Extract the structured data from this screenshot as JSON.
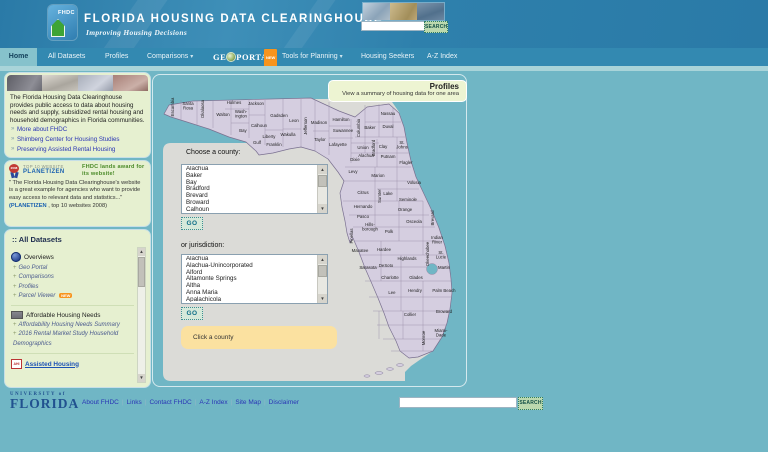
{
  "header": {
    "logo_text": "FHDC",
    "title": "FLORIDA HOUSING DATA CLEARINGHOUSE",
    "tagline": "Improving Housing Decisions",
    "search_placeholder": "",
    "search_button": "SEARCH"
  },
  "nav": {
    "items": [
      {
        "label": "Home",
        "active": true
      },
      {
        "label": "All Datasets"
      },
      {
        "label": "Profiles"
      },
      {
        "label": "Comparisons",
        "dropdown": true
      },
      {
        "label": "GEOPORTAL",
        "geo": true,
        "geo_parts": [
          "GE",
          "PORTAL"
        ],
        "badge": "NEW"
      },
      {
        "label": "Tools for Planning",
        "dropdown": true
      },
      {
        "label": "Housing Seekers"
      },
      {
        "label": "A-Z Index"
      }
    ]
  },
  "sidebar": {
    "intro": {
      "text": "The Florida Housing Data Clearinghouse provides public access to data about housing needs and supply, subsidized rental housing and household demographics in Florida communities.",
      "links": [
        "More about FHDC",
        "Shimberg Center for Housing Studies",
        "Preserving Assisted Rental Housing"
      ]
    },
    "award": {
      "year": "2008",
      "top_label": "TOP 10 WEBSITE",
      "brand": "PLANETIZEN",
      "headline": "FHDC lands award for its website!",
      "quote": "\" The Florida Housing Data Clearinghouse's website is a great example for agencies who want to provide easy access to relevant data and statistics...\"",
      "credit_brand": "(PLANETIZEN",
      "credit_rest": " , top 10 websites 2008)"
    },
    "datasets": {
      "title": ":: All Datasets",
      "sections": [
        {
          "heading": "Overviews",
          "icon": "globe",
          "links": [
            {
              "label": "Geo Portal"
            },
            {
              "label": "Comparisons"
            },
            {
              "label": "Profiles"
            },
            {
              "label": "Parcel Viewer",
              "badge": "NEW"
            }
          ]
        },
        {
          "heading": "Affordable Housing Needs",
          "icon": "building",
          "links": [
            {
              "label": "Affordability Housing Needs Summary"
            },
            {
              "label": "2016 Rental Market Study Household Demographics"
            }
          ]
        },
        {
          "heading": "Assisted Housing",
          "icon": "ahi",
          "heading_link": true,
          "links": []
        }
      ]
    }
  },
  "main": {
    "profiles_title": "Profiles",
    "profiles_subtitle": "View a summary of housing data for one area",
    "county_label": "Choose a county:",
    "county_options": [
      "Alachua",
      "Baker",
      "Bay",
      "Bradford",
      "Brevard",
      "Broward",
      "Calhoun"
    ],
    "go_label": "GO",
    "jurisdiction_label": "or jurisdiction:",
    "jurisdiction_options": [
      "Alachua",
      "Alachua-Unincorporated",
      "Alford",
      "Altamonte Springs",
      "Altha",
      "Anna Maria",
      "Apalachicola"
    ],
    "hint": "Click a county"
  },
  "map": {
    "counties": [
      {
        "n": "Escambia",
        "x": 21,
        "y": 32,
        "r": 1
      },
      {
        "n": "Santa|Rosa",
        "x": 35,
        "y": 30
      },
      {
        "n": "Okaloosa",
        "x": 51,
        "y": 34,
        "r": 1
      },
      {
        "n": "Walton",
        "x": 70,
        "y": 41
      },
      {
        "n": "Holmes",
        "x": 81,
        "y": 29
      },
      {
        "n": "Wash-|ington",
        "x": 88,
        "y": 38
      },
      {
        "n": "Jackson",
        "x": 103,
        "y": 30
      },
      {
        "n": "Bay",
        "x": 90,
        "y": 57
      },
      {
        "n": "Calhoun",
        "x": 106,
        "y": 52
      },
      {
        "n": "Gadsden",
        "x": 126,
        "y": 42
      },
      {
        "n": "Liberty",
        "x": 116,
        "y": 63
      },
      {
        "n": "Gulf",
        "x": 104,
        "y": 69
      },
      {
        "n": "Franklin",
        "x": 121,
        "y": 71
      },
      {
        "n": "Leon",
        "x": 141,
        "y": 47
      },
      {
        "n": "Wakulla",
        "x": 135,
        "y": 61
      },
      {
        "n": "Jefferson",
        "x": 154,
        "y": 51,
        "r": 1
      },
      {
        "n": "Madison",
        "x": 166,
        "y": 49
      },
      {
        "n": "Taylor",
        "x": 167,
        "y": 66
      },
      {
        "n": "Hamilton",
        "x": 188,
        "y": 46
      },
      {
        "n": "Suwannee",
        "x": 190,
        "y": 57
      },
      {
        "n": "Lafayette",
        "x": 185,
        "y": 71
      },
      {
        "n": "Dixie",
        "x": 202,
        "y": 86
      },
      {
        "n": "Columbia",
        "x": 207,
        "y": 53,
        "r": 1
      },
      {
        "n": "Baker",
        "x": 217,
        "y": 54
      },
      {
        "n": "Nassau",
        "x": 235,
        "y": 40
      },
      {
        "n": "Duval",
        "x": 235,
        "y": 53
      },
      {
        "n": "Union",
        "x": 210,
        "y": 74
      },
      {
        "n": "Bradford",
        "x": 222,
        "y": 73,
        "r": 1
      },
      {
        "n": "Clay",
        "x": 230,
        "y": 73
      },
      {
        "n": "St.|Johns",
        "x": 249,
        "y": 69
      },
      {
        "n": "Alachua",
        "x": 213,
        "y": 82
      },
      {
        "n": "Putnam",
        "x": 235,
        "y": 83
      },
      {
        "n": "Flagler",
        "x": 253,
        "y": 89
      },
      {
        "n": "Levy",
        "x": 200,
        "y": 98
      },
      {
        "n": "Marion",
        "x": 225,
        "y": 102
      },
      {
        "n": "Volusia",
        "x": 261,
        "y": 109
      },
      {
        "n": "Citrus",
        "x": 210,
        "y": 119
      },
      {
        "n": "Lake",
        "x": 235,
        "y": 120
      },
      {
        "n": "Sumter",
        "x": 228,
        "y": 121,
        "r": 1
      },
      {
        "n": "Seminole",
        "x": 255,
        "y": 126
      },
      {
        "n": "Hernando",
        "x": 210,
        "y": 133
      },
      {
        "n": "Orange",
        "x": 252,
        "y": 136
      },
      {
        "n": "Pasco",
        "x": 210,
        "y": 143
      },
      {
        "n": "Osceola",
        "x": 261,
        "y": 148
      },
      {
        "n": "Brevard",
        "x": 281,
        "y": 143,
        "r": 1
      },
      {
        "n": "Hills-|borough",
        "x": 217,
        "y": 151
      },
      {
        "n": "Pinellas",
        "x": 200,
        "y": 161,
        "r": 1
      },
      {
        "n": "Polk",
        "x": 236,
        "y": 158
      },
      {
        "n": "Indian|River",
        "x": 284,
        "y": 164
      },
      {
        "n": "Manatee",
        "x": 207,
        "y": 177
      },
      {
        "n": "Hardee",
        "x": 231,
        "y": 176
      },
      {
        "n": "Highlands",
        "x": 254,
        "y": 185
      },
      {
        "n": "Okeechobee",
        "x": 276,
        "y": 179,
        "r": 1
      },
      {
        "n": "St.|Lucie",
        "x": 288,
        "y": 179
      },
      {
        "n": "Sarasota",
        "x": 215,
        "y": 194
      },
      {
        "n": "DeSoto",
        "x": 233,
        "y": 192
      },
      {
        "n": "Martin",
        "x": 291,
        "y": 194
      },
      {
        "n": "Charlotte",
        "x": 237,
        "y": 204
      },
      {
        "n": "Glades",
        "x": 263,
        "y": 204
      },
      {
        "n": "Lee",
        "x": 239,
        "y": 219
      },
      {
        "n": "Hendry",
        "x": 262,
        "y": 217
      },
      {
        "n": "Palm Beach",
        "x": 291,
        "y": 217
      },
      {
        "n": "Collier",
        "x": 257,
        "y": 241
      },
      {
        "n": "Broward",
        "x": 291,
        "y": 238
      },
      {
        "n": "Monroe",
        "x": 272,
        "y": 263,
        "r": 1
      },
      {
        "n": "Miami-|Dade",
        "x": 288,
        "y": 257
      }
    ]
  },
  "footer": {
    "university_top": "UNIVERSITY of",
    "university_name": "FLORIDA",
    "links": [
      "About FHDC",
      "Links",
      "Contact FHDC",
      "A-Z Index",
      "Site Map",
      "Disclaimer"
    ],
    "search_placeholder": "",
    "search_button": "SEARCH"
  },
  "colors": {
    "page_teal": "#70b6c5",
    "header_blue": "#2e80ac",
    "nav_blue": "#3389b1",
    "active_tab": "#86c2cc",
    "sidebar_green": "#e6f0d0",
    "map_backdrop": "#dbdbd7",
    "county_fill": "#d5cee0",
    "hint_yellow": "#fbe1a0",
    "new_badge_orange": "#f7941d"
  }
}
